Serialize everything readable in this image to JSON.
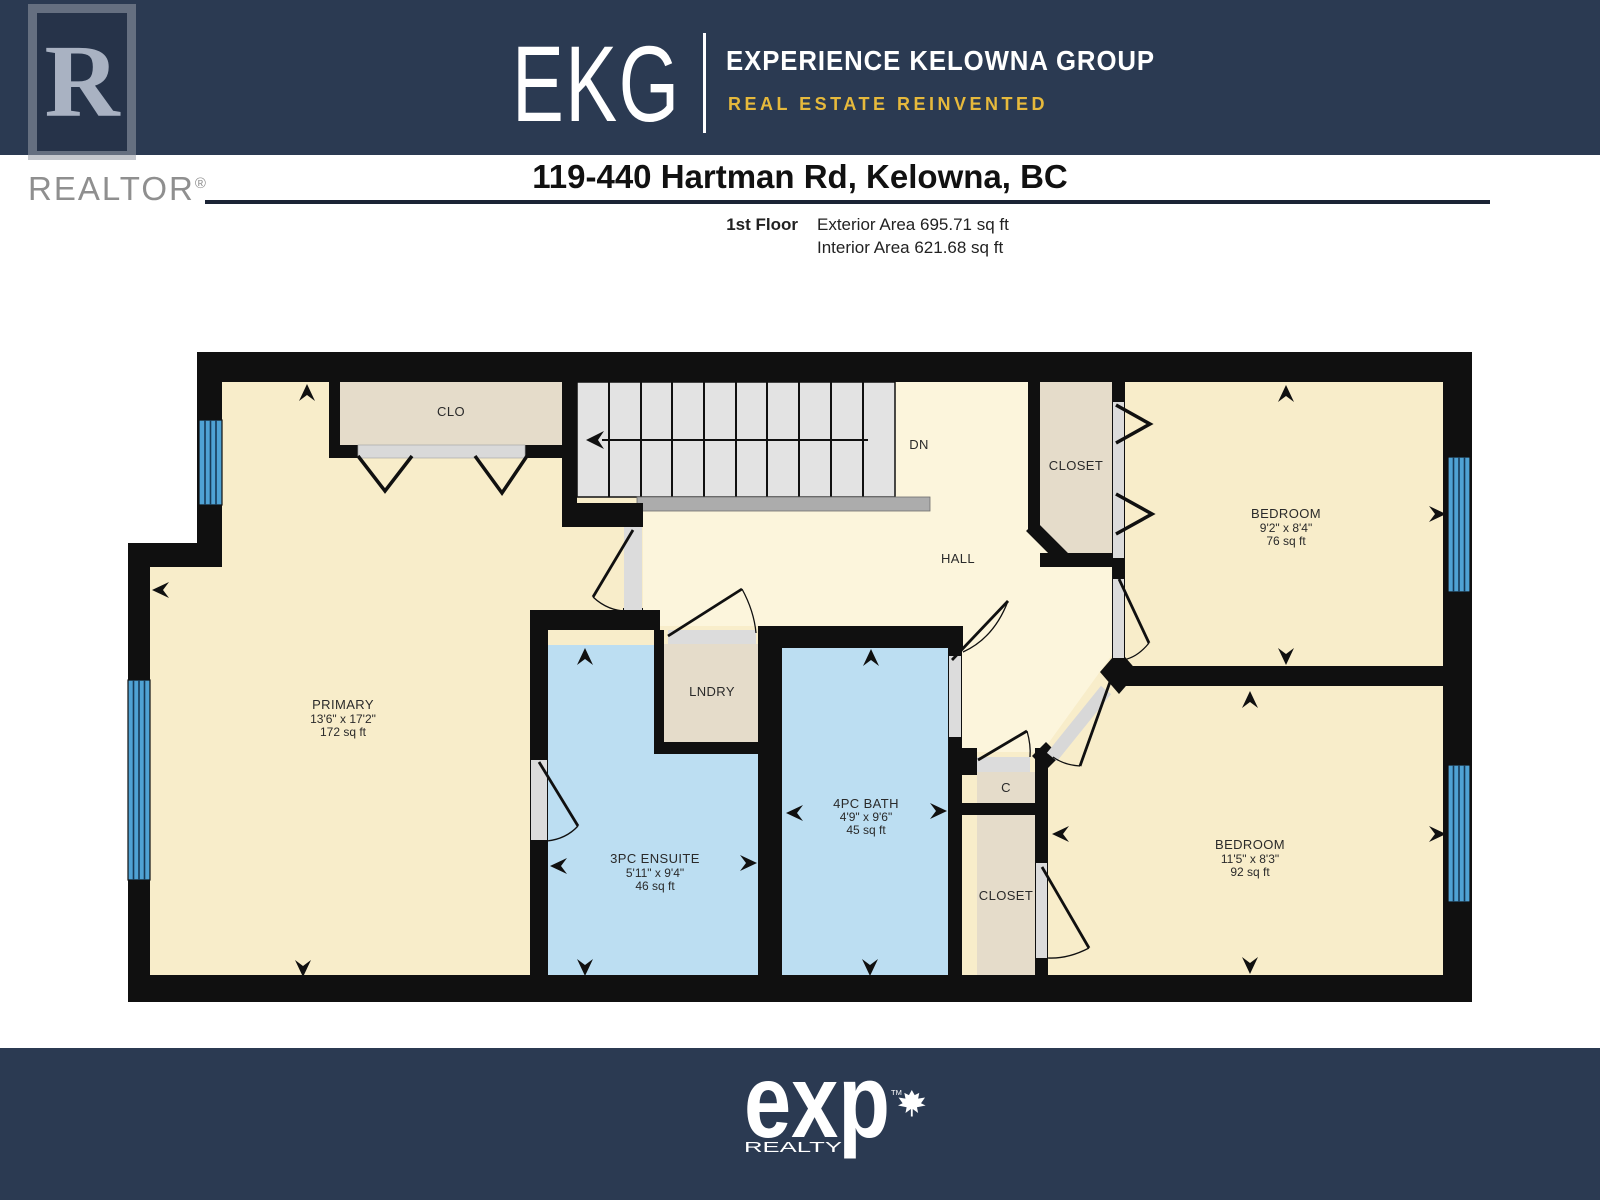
{
  "header": {
    "brand_abbr": "EKG",
    "brand_name": "EXPERIENCE KELOWNA GROUP",
    "brand_tagline": "REAL ESTATE REINVENTED",
    "realtor_letter": "R",
    "realtor_text": "REALTOR",
    "realtor_reg": "®",
    "banner_color": "#2b3a52",
    "tagline_color": "#e6b93c"
  },
  "title": {
    "address": "119-440 Hartman Rd, Kelowna, BC",
    "floor_label": "1st Floor",
    "exterior_area": "Exterior Area 695.71 sq ft",
    "interior_area": "Interior Area 621.68 sq ft"
  },
  "floorplan": {
    "colors": {
      "wall": "#101010",
      "room_fill": "#f8edca",
      "hall_fill": "#fcf5dc",
      "bath_fill": "#bcdef2",
      "closet_fill": "#e5dcca",
      "stairs_fill": "#e3e3e3",
      "window_blue": "#4fa2d4"
    },
    "rooms": {
      "primary": {
        "name": "PRIMARY",
        "dims": "13'6\" x 17'2\"",
        "area": "172 sq ft"
      },
      "ensuite": {
        "name": "3PC ENSUITE",
        "dims": "5'11\" x 9'4\"",
        "area": "46 sq ft"
      },
      "bath": {
        "name": "4PC BATH",
        "dims": "4'9\" x 9'6\"",
        "area": "45 sq ft"
      },
      "bedroom1": {
        "name": "BEDROOM",
        "dims": "9'2\" x 8'4\"",
        "area": "76 sq ft"
      },
      "bedroom2": {
        "name": "BEDROOM",
        "dims": "11'5\" x 8'3\"",
        "area": "92 sq ft"
      },
      "hall": {
        "name": "HALL"
      },
      "lndry": {
        "name": "LNDRY"
      },
      "clo": {
        "name": "CLO"
      },
      "closet_hall": {
        "name": "CLOSET"
      },
      "closet_c": {
        "name": "C"
      },
      "closet_bed2": {
        "name": "CLOSET"
      },
      "stairs_label": "DN"
    }
  },
  "footer": {
    "brand": "exp",
    "brand_sub": "REALTY",
    "tm": "TM"
  }
}
